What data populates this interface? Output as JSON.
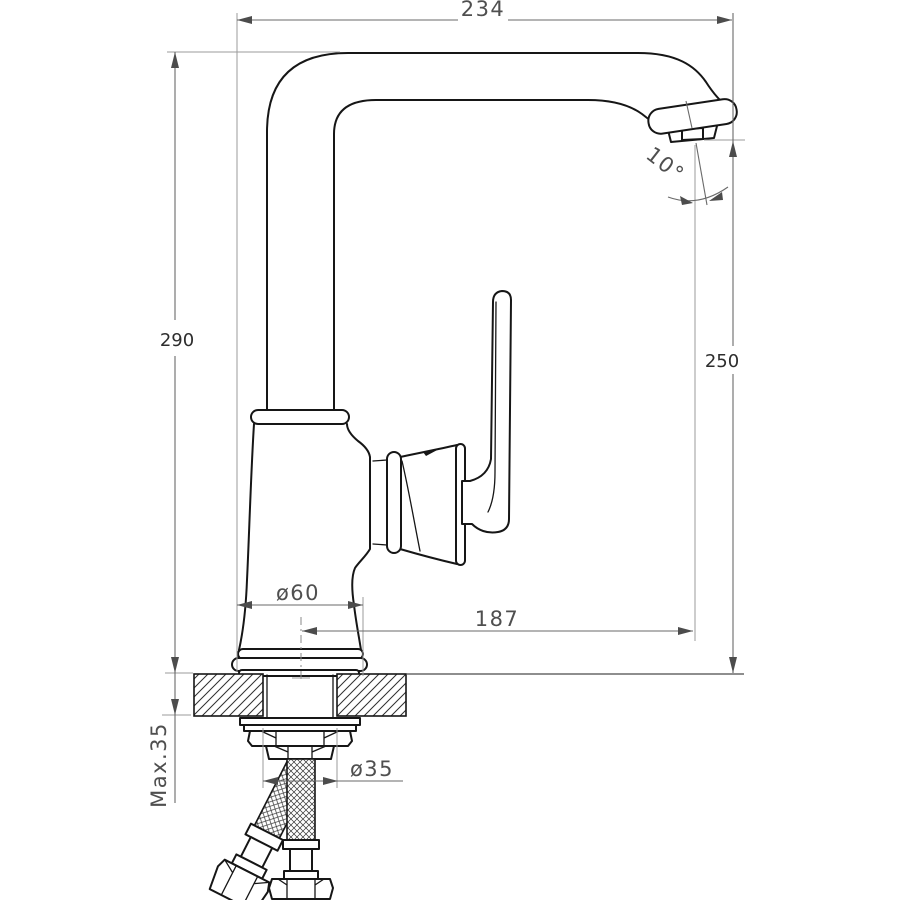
{
  "drawing": {
    "type": "faucet-installation-technical-drawing",
    "units_shown": "mm",
    "dimensions": {
      "top_width": "234",
      "total_height": "290",
      "spout_height": "250",
      "spout_angle": "10°",
      "base_diameter": "ø60",
      "spout_reach": "187",
      "max_counter_thickness": "Max.35",
      "shank_diameter": "ø35"
    },
    "colors": {
      "object_line": "#161616",
      "dimension_line": "#6a6a6a",
      "extension_line": "#9b9b9b",
      "background": "#ffffff"
    }
  }
}
